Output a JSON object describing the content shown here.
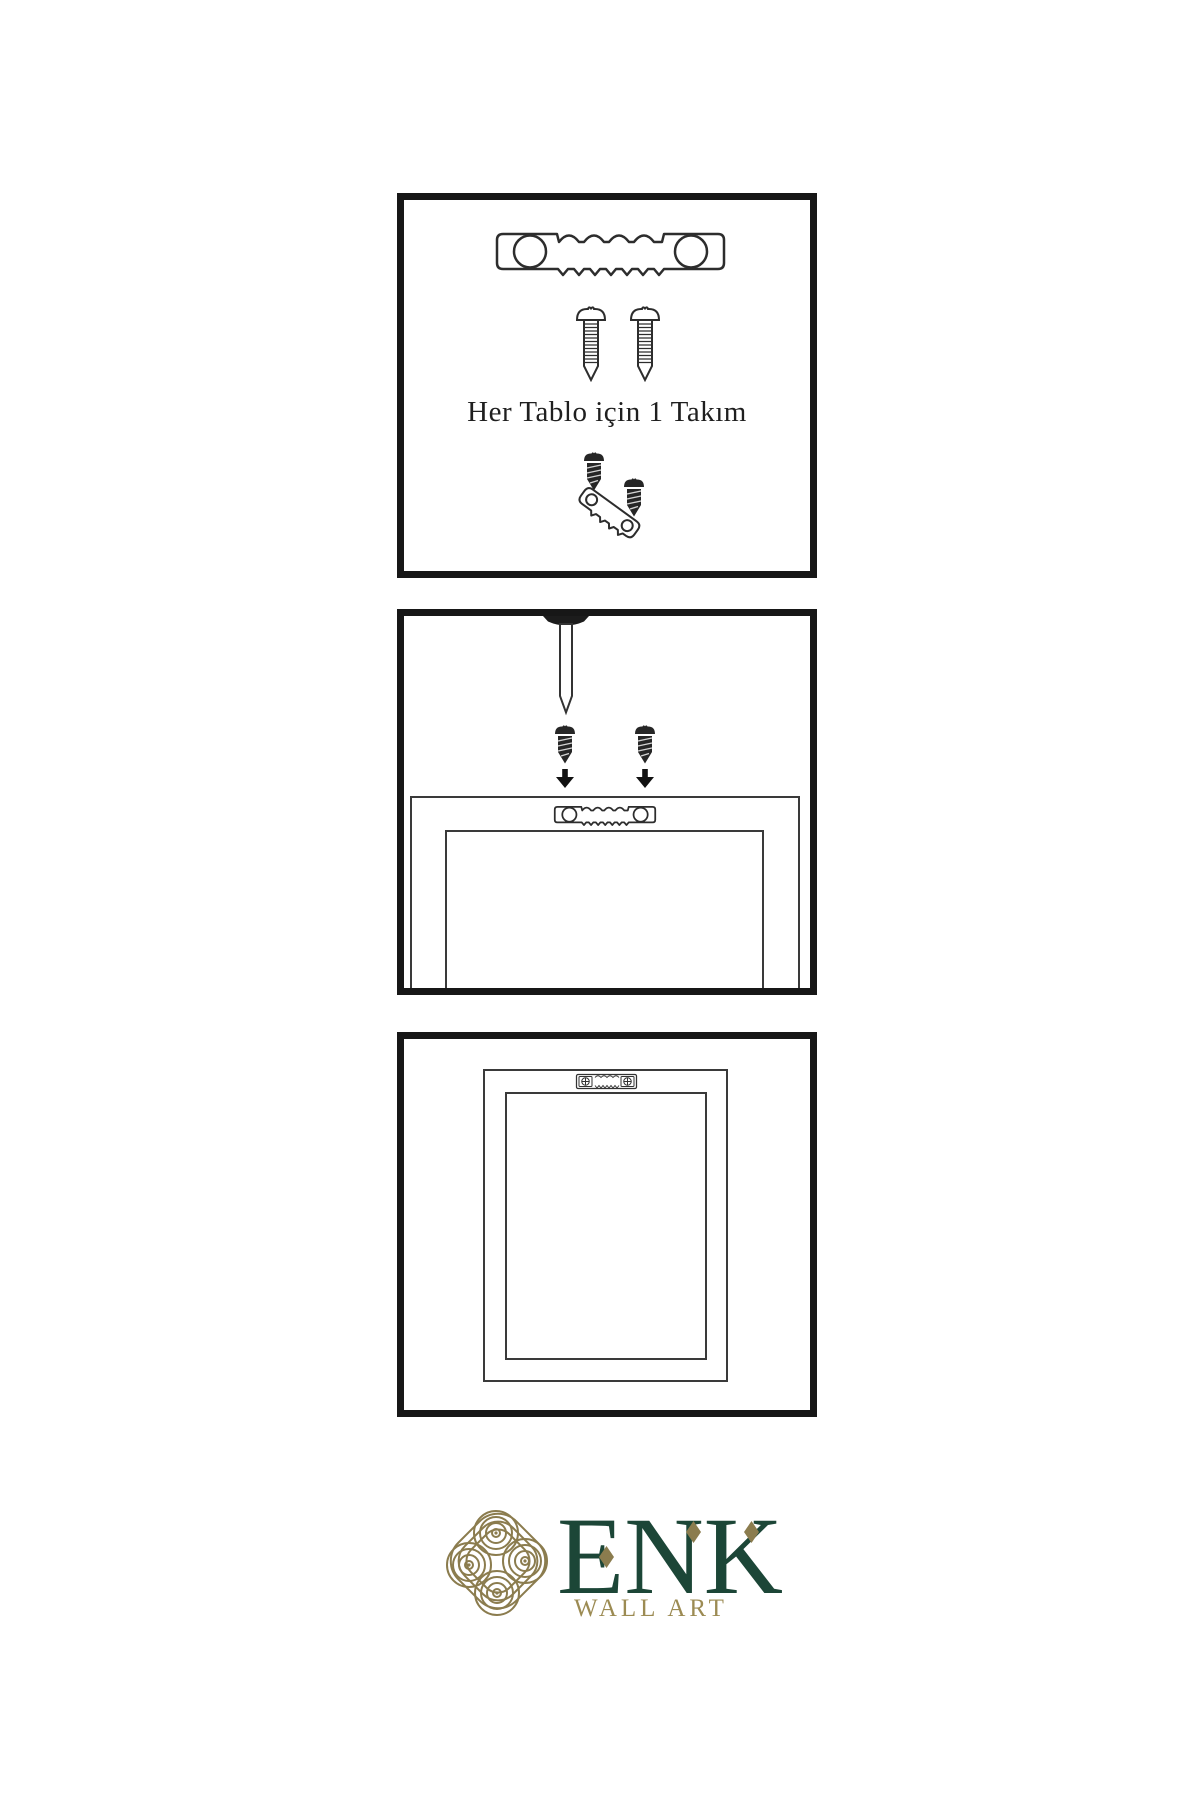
{
  "title": "Wall art hanging instruction sheet",
  "colors": {
    "background": "#ffffff",
    "panel_border": "#171717",
    "diagram_line": "#333333",
    "dark_hardware_fill": "#262626",
    "brand_green": "#1c4637",
    "brand_gold": "#8b7c4e",
    "brand_gold_text": "#9c8b53"
  },
  "panels": [
    {
      "name": "hardware-kit",
      "caption": "Her Tablo için 1 Takım",
      "icons": [
        "sawtooth-hanger-icon",
        "screw-icon",
        "screw-icon",
        "dark-screw-icon",
        "tilted-sawtooth-hanger-icon",
        "dark-screw-icon"
      ]
    },
    {
      "name": "wall-installation",
      "icons": [
        "nail-icon",
        "dark-screw-icon",
        "down-arrow-icon",
        "dark-screw-icon",
        "down-arrow-icon",
        "sawtooth-hanger-icon",
        "picture-frame-back"
      ]
    },
    {
      "name": "hanging-result",
      "icons": [
        "mounted-sawtooth-hanger-icon",
        "picture-frame-back"
      ]
    }
  ],
  "logo": {
    "name": "ENK",
    "subtitle": "WALL ART",
    "icon": "knot-logo-icon"
  }
}
